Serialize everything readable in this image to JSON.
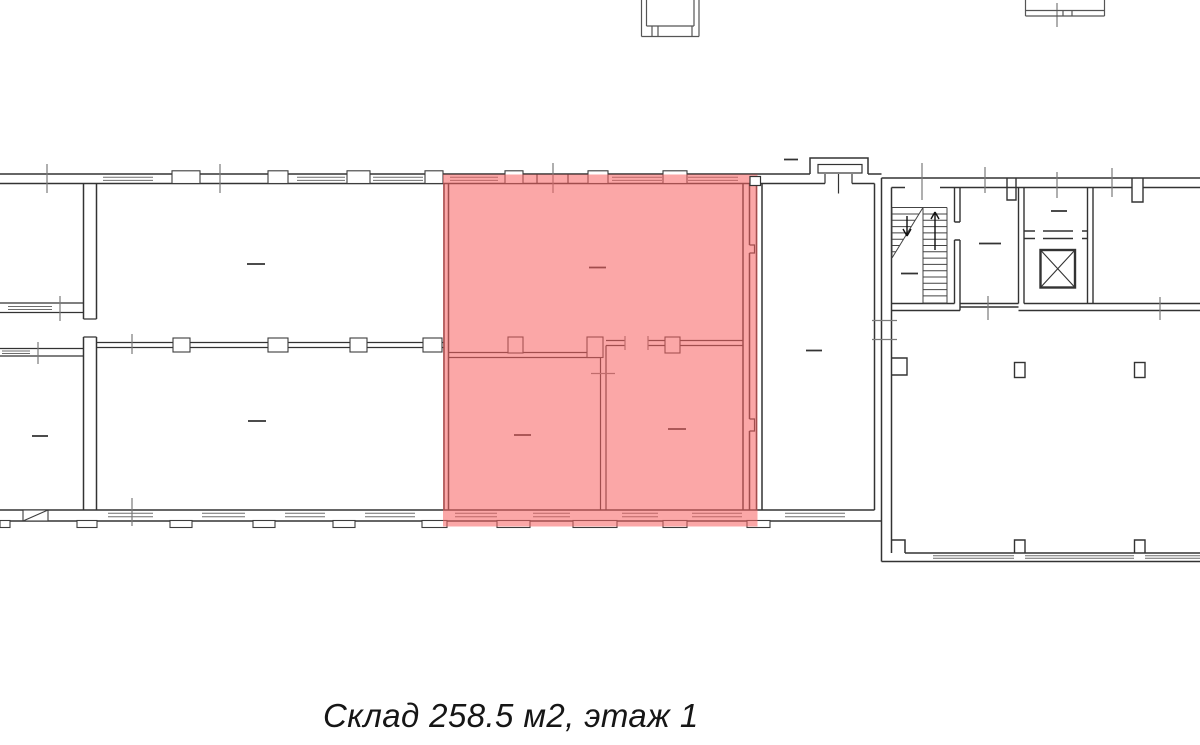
{
  "caption": {
    "text": "Склад 258.5 м2, этаж 1"
  },
  "highlight": {
    "fill": "#F76262",
    "opacity": "0.56"
  },
  "colors": {
    "wall_line": "#333333",
    "background": "#FFFFFF"
  },
  "plan": {
    "type": "floor-plan",
    "highlighted_rooms": 3,
    "features": [
      "staircase",
      "elevator-shaft",
      "entrance-vestibule",
      "windows",
      "columns"
    ]
  }
}
